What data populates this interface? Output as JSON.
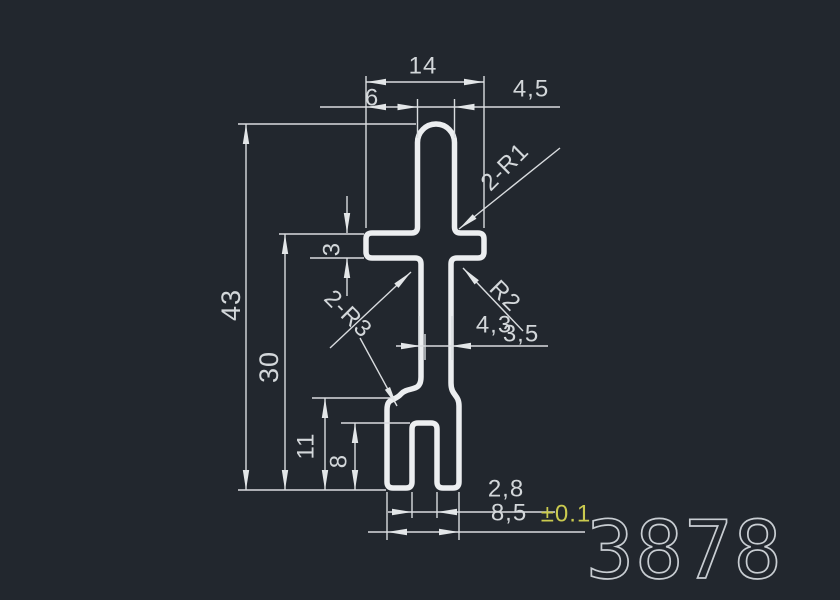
{
  "drawing": {
    "type": "CAD profile cross-section drawing",
    "product_code": "3878",
    "colors": {
      "background": "#22272e",
      "profile_line": "#eceef0",
      "dimension_line": "#d9dcdf",
      "dimension_text": "#d3d7da",
      "tolerance_text": "#caca4f",
      "code_text": "#c8cdd2"
    },
    "dimensions": {
      "top_arm_width": "14",
      "top_left_overhang": "6",
      "stem_width": "4,5",
      "arm_thickness": "3",
      "overall_height": "43",
      "lower_height": "30",
      "flare_height": "11",
      "slot_depth": "8",
      "neck_width_a": "4,3",
      "neck_width_b": "3,5",
      "slot_width": "2,8",
      "foot_width": "8,5",
      "foot_width_tolerance": "±0.1"
    },
    "labels": {
      "fillet_top": "2-R1",
      "fillet_left": "2-R3",
      "fillet_right": "R2"
    }
  }
}
